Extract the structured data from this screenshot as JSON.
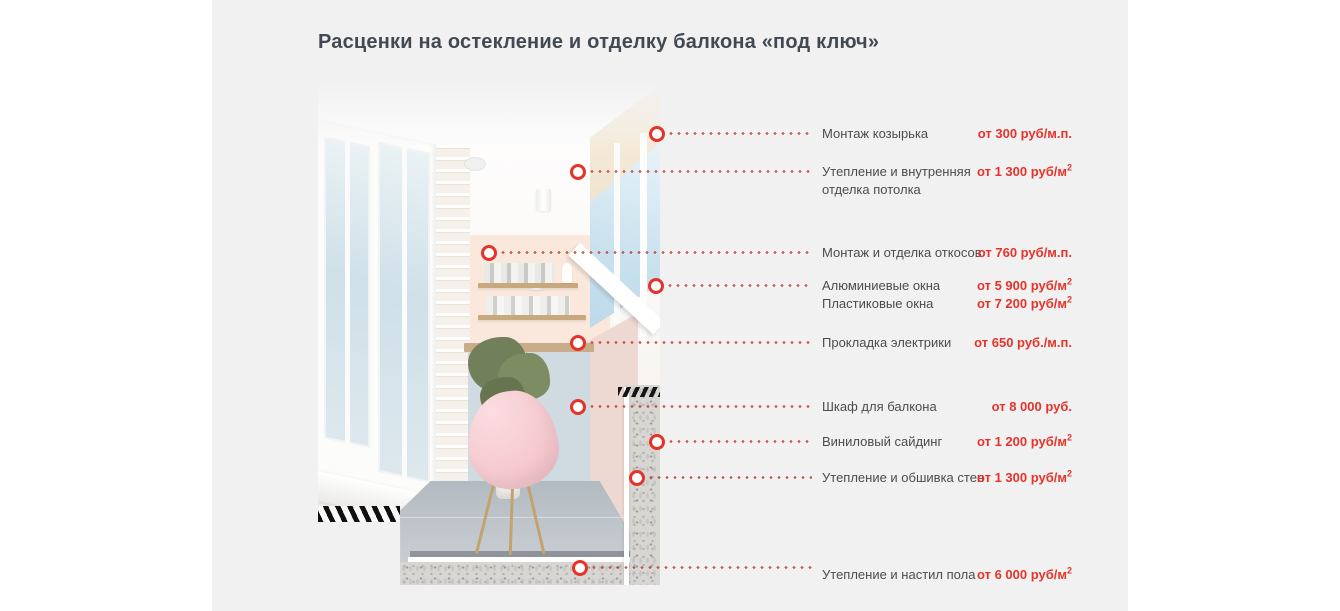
{
  "page": {
    "title": "Расценки на остекление и отделку балкона «под ключ»",
    "colors": {
      "section_background": "#f1f1f2",
      "accent_red": "#e6332a",
      "dotted_line_red": "#c14338",
      "label_gray": "#4c4c4c",
      "title_color": "#414a52"
    }
  },
  "photo": {
    "description": "balcony-interior-cutaway-photo"
  },
  "items": [
    {
      "label": "Монтаж козырька",
      "price": "от 300 руб/м.п."
    },
    {
      "label": "Утепление и внутренняя отделка потолка",
      "price": "от 1 300 руб/м",
      "price_sup": "2"
    },
    {
      "label": "Монтаж и отделка откосов",
      "price": "от 760 руб/м.п."
    },
    {
      "label": "Алюминиевые окна",
      "price": "от 5 900 руб/м",
      "price_sup": "2"
    },
    {
      "label": "Пластиковые окна",
      "price": "от 7 200 руб/м",
      "price_sup": "2"
    },
    {
      "label": "Прокладка электрики",
      "price": "от 650 руб./м.п."
    },
    {
      "label": "Шкаф для балкона",
      "price": "от 8 000 руб."
    },
    {
      "label": "Виниловый сайдинг",
      "price": "от 1 200 руб/м",
      "price_sup": "2"
    },
    {
      "label": "Утепление и обшивка стен",
      "price": "от 1 300 руб/м",
      "price_sup": "2"
    },
    {
      "label": "Утепление и настил пола",
      "price": "от 6 000 руб/м",
      "price_sup": "2"
    }
  ]
}
